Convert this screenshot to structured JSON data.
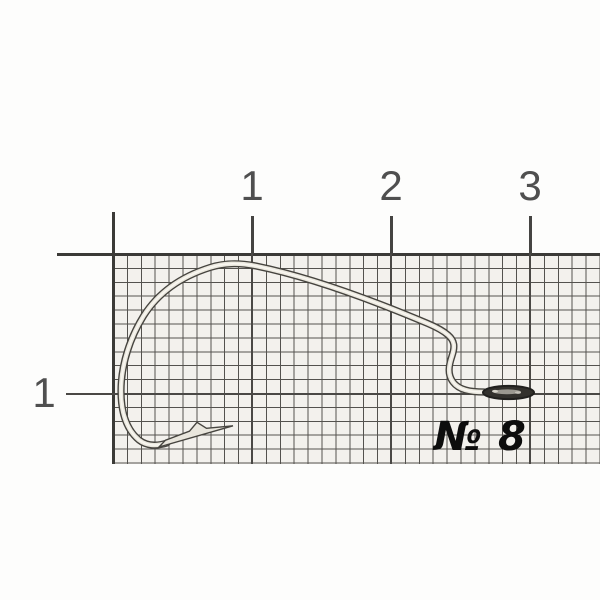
{
  "ruler": {
    "top_tick_labels": [
      "1",
      "2",
      "3"
    ],
    "left_tick_label": "1"
  },
  "annotation": {
    "size_label": "№ 8"
  },
  "colors": {
    "background": "#fdfdfc",
    "grid_paper_fill": "#f3f1ed",
    "grid_minor_line": "#54524e",
    "grid_major_line": "#3b3a37",
    "ruler_numeral": "#4f4f4f",
    "hook_outline": "#46443f",
    "hook_body": "#ebe8df",
    "hook_highlight": "#f9f7f1",
    "hook_eye": "#33312d",
    "size_label_text": "#0d0d0d"
  },
  "hook": {
    "wire_path": "M 484 392 C 470 392 459 390 453 382 C 447 374 449 365 452 356 C 455 347 455 341 448 335 C 443 330.6 436 327 428 323.6 C 391 308 320 279 256 266 C 238 262.5 224 263 210 267.5 C 183 276 159 291.5 143.5 316 C 130.5 337 121 364 121 391 C 121 413 127 430 139 440 C 146 445.5 156 446.5 167 443",
    "point_path": "M 159 447 L 233 425.8 L 206.5 428.3 L 197 422.3 L 189.5 431.2 L 165.5 440.2 Z"
  }
}
